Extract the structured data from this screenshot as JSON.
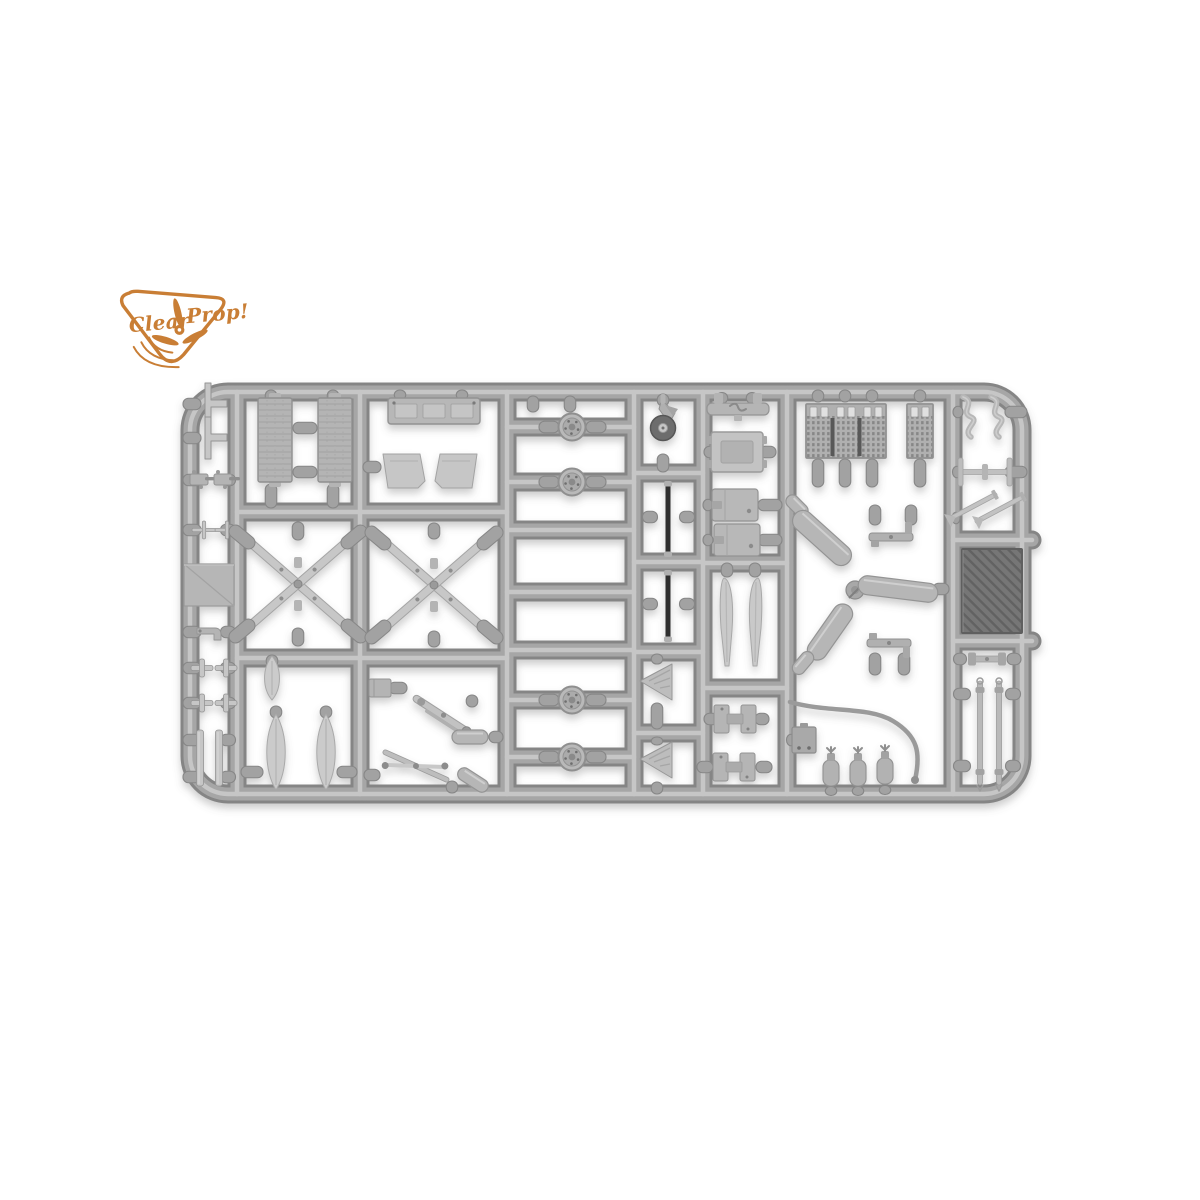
{
  "photo": {
    "subject": "injection-molded model kit sprue with aircraft detail parts",
    "background_color": "#ffffff"
  },
  "logo": {
    "word1": "Clear",
    "word2": "Prop!",
    "color": "#c97e35"
  },
  "sprue": {
    "colors": {
      "runner_edge": "#858585",
      "runner_mid": "#a6a6a6",
      "runner_hi": "#c6c6c6",
      "gate_fill": "#a2a2a2",
      "gate_edge": "#878787",
      "part_light": "#c6c6c6",
      "part_mid": "#b4b4b4",
      "part_edge": "#949494",
      "part_dark": "#6f6f6f",
      "rod_dark": "#2e2e2e",
      "panel_dark": "#757575"
    },
    "frame": {
      "x": 190,
      "y": 392,
      "w": 832,
      "h": 402,
      "rx": 38
    },
    "verticals": [
      237,
      360,
      507,
      634,
      703,
      787,
      953
    ],
    "horizontals": [
      [
        237,
        507,
        512
      ],
      [
        237,
        507,
        658
      ],
      [
        507,
        634,
        427
      ],
      [
        507,
        634,
        482
      ],
      [
        507,
        634,
        530
      ],
      [
        507,
        634,
        592
      ],
      [
        507,
        634,
        650
      ],
      [
        507,
        634,
        700
      ],
      [
        507,
        634,
        757
      ],
      [
        634,
        703,
        473
      ],
      [
        634,
        703,
        562
      ],
      [
        634,
        703,
        652
      ],
      [
        634,
        703,
        733
      ],
      [
        703,
        787,
        563
      ],
      [
        703,
        787,
        688
      ],
      [
        953,
        1032,
        540
      ],
      [
        953,
        1032,
        641
      ]
    ],
    "wire": "M 790,702 C 828,713 868,706 893,721 C 918,736 921,753 915,780",
    "stubs": [
      [
        192,
        404,
        18,
        "h"
      ],
      [
        192,
        438,
        18,
        "h"
      ],
      [
        192,
        480,
        18,
        "h"
      ],
      [
        228,
        480,
        15,
        "h"
      ],
      [
        192,
        530,
        18,
        "h"
      ],
      [
        228,
        530,
        15,
        "h"
      ],
      [
        192,
        632,
        18,
        "h"
      ],
      [
        228,
        632,
        15,
        "h"
      ],
      [
        192,
        668,
        18,
        "h"
      ],
      [
        228,
        668,
        15,
        "h"
      ],
      [
        192,
        703,
        18,
        "h"
      ],
      [
        228,
        703,
        15,
        "h"
      ],
      [
        192,
        740,
        18,
        "h"
      ],
      [
        228,
        740,
        15,
        "h"
      ],
      [
        192,
        777,
        18,
        "h"
      ],
      [
        228,
        777,
        15,
        "h"
      ],
      [
        271,
        396,
        12,
        "v"
      ],
      [
        333,
        396,
        12,
        "v"
      ],
      [
        305,
        428,
        24,
        "h"
      ],
      [
        305,
        472,
        24,
        "h"
      ],
      [
        271,
        496,
        24,
        "v"
      ],
      [
        333,
        496,
        24,
        "v"
      ],
      [
        298,
        531,
        18,
        "v"
      ],
      [
        298,
        637,
        18,
        "v"
      ],
      [
        272,
        661,
        12,
        "v"
      ],
      [
        276,
        712,
        12,
        "v"
      ],
      [
        326,
        712,
        12,
        "v"
      ],
      [
        252,
        772,
        22,
        "h"
      ],
      [
        347,
        772,
        20,
        "h"
      ],
      [
        400,
        395,
        10,
        "v"
      ],
      [
        462,
        395,
        10,
        "v"
      ],
      [
        372,
        467,
        18,
        "h"
      ],
      [
        434,
        531,
        16,
        "v"
      ],
      [
        434,
        639,
        16,
        "v"
      ],
      [
        398,
        688,
        18,
        "h"
      ],
      [
        472,
        701,
        12,
        "v"
      ],
      [
        496,
        737,
        14,
        "h"
      ],
      [
        372,
        775,
        16,
        "h"
      ],
      [
        452,
        787,
        12,
        "v"
      ],
      [
        533,
        404,
        16,
        "v"
      ],
      [
        570,
        404,
        16,
        "v"
      ],
      [
        549,
        427,
        20,
        "h"
      ],
      [
        596,
        427,
        20,
        "h"
      ],
      [
        549,
        482,
        20,
        "h"
      ],
      [
        596,
        482,
        20,
        "h"
      ],
      [
        549,
        700,
        20,
        "h"
      ],
      [
        596,
        700,
        20,
        "h"
      ],
      [
        549,
        757,
        20,
        "h"
      ],
      [
        596,
        757,
        20,
        "h"
      ],
      [
        663,
        400,
        12,
        "v"
      ],
      [
        663,
        463,
        18,
        "v"
      ],
      [
        650,
        517,
        15,
        "h"
      ],
      [
        687,
        517,
        15,
        "h"
      ],
      [
        650,
        604,
        15,
        "h"
      ],
      [
        687,
        604,
        15,
        "h"
      ],
      [
        657,
        659,
        10,
        "v"
      ],
      [
        657,
        716,
        26,
        "v"
      ],
      [
        657,
        741,
        8,
        "v"
      ],
      [
        657,
        788,
        12,
        "v"
      ],
      [
        722,
        398,
        11,
        "v"
      ],
      [
        752,
        398,
        11,
        "v"
      ],
      [
        710,
        452,
        12,
        "h"
      ],
      [
        768,
        452,
        16,
        "h"
      ],
      [
        708,
        505,
        10,
        "h"
      ],
      [
        770,
        505,
        24,
        "h"
      ],
      [
        708,
        540,
        10,
        "h"
      ],
      [
        770,
        540,
        24,
        "h"
      ],
      [
        727,
        570,
        14,
        "v"
      ],
      [
        755,
        570,
        14,
        "v"
      ],
      [
        711,
        719,
        14,
        "h"
      ],
      [
        762,
        719,
        14,
        "h"
      ],
      [
        705,
        767,
        16,
        "h"
      ],
      [
        764,
        767,
        16,
        "h"
      ],
      [
        818,
        396,
        12,
        "v"
      ],
      [
        845,
        396,
        12,
        "v"
      ],
      [
        872,
        396,
        12,
        "v"
      ],
      [
        920,
        396,
        12,
        "v"
      ],
      [
        818,
        473,
        28,
        "v"
      ],
      [
        845,
        473,
        28,
        "v"
      ],
      [
        872,
        473,
        28,
        "v"
      ],
      [
        920,
        473,
        28,
        "v"
      ],
      [
        875,
        515,
        20,
        "v"
      ],
      [
        911,
        515,
        20,
        "v"
      ],
      [
        875,
        664,
        22,
        "v"
      ],
      [
        904,
        664,
        22,
        "v"
      ],
      [
        941,
        589,
        16,
        "h"
      ],
      [
        791,
        740,
        9,
        "h"
      ],
      [
        831,
        791,
        9,
        "v"
      ],
      [
        858,
        791,
        9,
        "v"
      ],
      [
        885,
        790,
        9,
        "v"
      ],
      [
        958,
        412,
        10,
        "h"
      ],
      [
        1016,
        412,
        22,
        "h"
      ],
      [
        957,
        472,
        9,
        "h"
      ],
      [
        1016,
        472,
        22,
        "h"
      ],
      [
        956,
        518,
        8,
        "h"
      ],
      [
        960,
        659,
        13,
        "h"
      ],
      [
        1014,
        659,
        14,
        "h"
      ],
      [
        962,
        694,
        17,
        "h"
      ],
      [
        1013,
        694,
        15,
        "h"
      ],
      [
        962,
        766,
        17,
        "h"
      ],
      [
        1013,
        766,
        15,
        "h"
      ]
    ],
    "parts": [
      {
        "t": "tpart",
        "x": 214,
        "y": 404
      },
      {
        "t": "tpart",
        "x": 214,
        "y": 438
      },
      {
        "t": "gun",
        "x": 201,
        "y": 480
      },
      {
        "t": "gun",
        "x": 225,
        "y": 480
      },
      {
        "t": "pitot",
        "x": 204,
        "y": 530
      },
      {
        "t": "pitot",
        "x": 227,
        "y": 530
      },
      {
        "t": "panel",
        "x": 209,
        "y": 585
      },
      {
        "t": "hook",
        "x": 208,
        "y": 632
      },
      {
        "t": "cross",
        "x": 202,
        "y": 668
      },
      {
        "t": "cross",
        "x": 226,
        "y": 668
      },
      {
        "t": "cross",
        "x": 202,
        "y": 703
      },
      {
        "t": "cross",
        "x": 226,
        "y": 703
      },
      {
        "t": "strip",
        "x": 200,
        "y": 758
      },
      {
        "t": "strip",
        "x": 219,
        "y": 758
      },
      {
        "t": "radiator",
        "x": 275,
        "y": 440
      },
      {
        "t": "radiator",
        "x": 335,
        "y": 440
      },
      {
        "t": "xstrut",
        "x": 298,
        "y": 584
      },
      {
        "t": "blade",
        "x": 272,
        "y": 678,
        "w": 17,
        "h": 44
      },
      {
        "t": "blade",
        "x": 276,
        "y": 752,
        "w": 21,
        "h": 76
      },
      {
        "t": "blade",
        "x": 326,
        "y": 752,
        "w": 21,
        "h": 76
      },
      {
        "t": "longbox",
        "x": 434,
        "y": 411
      },
      {
        "t": "trap",
        "x": 404,
        "y": 471
      },
      {
        "t": "trap",
        "x": 456,
        "y": 471,
        "fl": 1
      },
      {
        "t": "xstrut",
        "x": 434,
        "y": 585
      },
      {
        "t": "boxs",
        "x": 380,
        "y": 688
      },
      {
        "t": "link",
        "x": 443,
        "y": 716,
        "r": 33
      },
      {
        "t": "cyl",
        "x": 470,
        "y": 737,
        "w": 36,
        "h": 14
      },
      {
        "t": "scissor",
        "x": 416,
        "y": 766,
        "r": 14
      },
      {
        "t": "cyl",
        "x": 473,
        "y": 780,
        "w": 34,
        "h": 13,
        "r": 33
      },
      {
        "t": "wheel",
        "x": 572,
        "y": 427
      },
      {
        "t": "wheel",
        "x": 572,
        "y": 482
      },
      {
        "t": "wheel",
        "x": 572,
        "y": 700
      },
      {
        "t": "wheel",
        "x": 572,
        "y": 757
      },
      {
        "t": "tailwheel",
        "x": 663,
        "y": 422
      },
      {
        "t": "darkrod",
        "x": 668,
        "y": 519,
        "h": 66
      },
      {
        "t": "darkrod",
        "x": 668,
        "y": 606,
        "h": 62
      },
      {
        "t": "cone",
        "x": 657,
        "y": 682
      },
      {
        "t": "cone",
        "x": 657,
        "y": 760
      },
      {
        "t": "ubracket",
        "x": 738,
        "y": 409
      },
      {
        "t": "framebox",
        "x": 737,
        "y": 452
      },
      {
        "t": "box",
        "x": 735,
        "y": 505
      },
      {
        "t": "box",
        "x": 737,
        "y": 540
      },
      {
        "t": "fin",
        "x": 727,
        "y": 622
      },
      {
        "t": "fin",
        "x": 755,
        "y": 622,
        "fl": 1
      },
      {
        "t": "hpart",
        "x": 735,
        "y": 719
      },
      {
        "t": "hpart",
        "x": 734,
        "y": 767
      },
      {
        "t": "grille3",
        "x": 846,
        "y": 431
      },
      {
        "t": "grille1",
        "x": 920,
        "y": 431
      },
      {
        "t": "cyl",
        "x": 797,
        "y": 506,
        "w": 26,
        "h": 13,
        "r": 45
      },
      {
        "t": "cyl",
        "x": 822,
        "y": 538,
        "w": 72,
        "h": 21,
        "r": 42
      },
      {
        "t": "junction",
        "x": 855,
        "y": 590
      },
      {
        "t": "cyl",
        "x": 898,
        "y": 589,
        "w": 80,
        "h": 19,
        "r": 7
      },
      {
        "t": "cyl",
        "x": 830,
        "y": 632,
        "w": 64,
        "h": 20,
        "r": -55
      },
      {
        "t": "cyl",
        "x": 803,
        "y": 663,
        "w": 26,
        "h": 13,
        "r": -50
      },
      {
        "t": "tbracket",
        "x": 891,
        "y": 537
      },
      {
        "t": "tbracket",
        "x": 889,
        "y": 643,
        "fv": 1
      },
      {
        "t": "wire",
        "x": 0,
        "y": 0
      },
      {
        "t": "plate",
        "x": 804,
        "y": 740
      },
      {
        "t": "bottle",
        "x": 831,
        "y": 772
      },
      {
        "t": "bottle",
        "x": 858,
        "y": 772
      },
      {
        "t": "bottle",
        "x": 885,
        "y": 770
      },
      {
        "t": "scurve",
        "x": 968,
        "y": 418
      },
      {
        "t": "scurve",
        "x": 996,
        "y": 418
      },
      {
        "t": "ibar",
        "x": 985,
        "y": 472
      },
      {
        "t": "diagrod",
        "x": 972,
        "y": 507,
        "r": -28
      },
      {
        "t": "diagrod",
        "x": 1000,
        "y": 509,
        "r": -28
      },
      {
        "t": "darkpanel",
        "x": 992,
        "y": 591
      },
      {
        "t": "dumbbell",
        "x": 987,
        "y": 659
      },
      {
        "t": "longrod",
        "x": 980,
        "y": 733
      },
      {
        "t": "longrod",
        "x": 999,
        "y": 733
      }
    ]
  }
}
